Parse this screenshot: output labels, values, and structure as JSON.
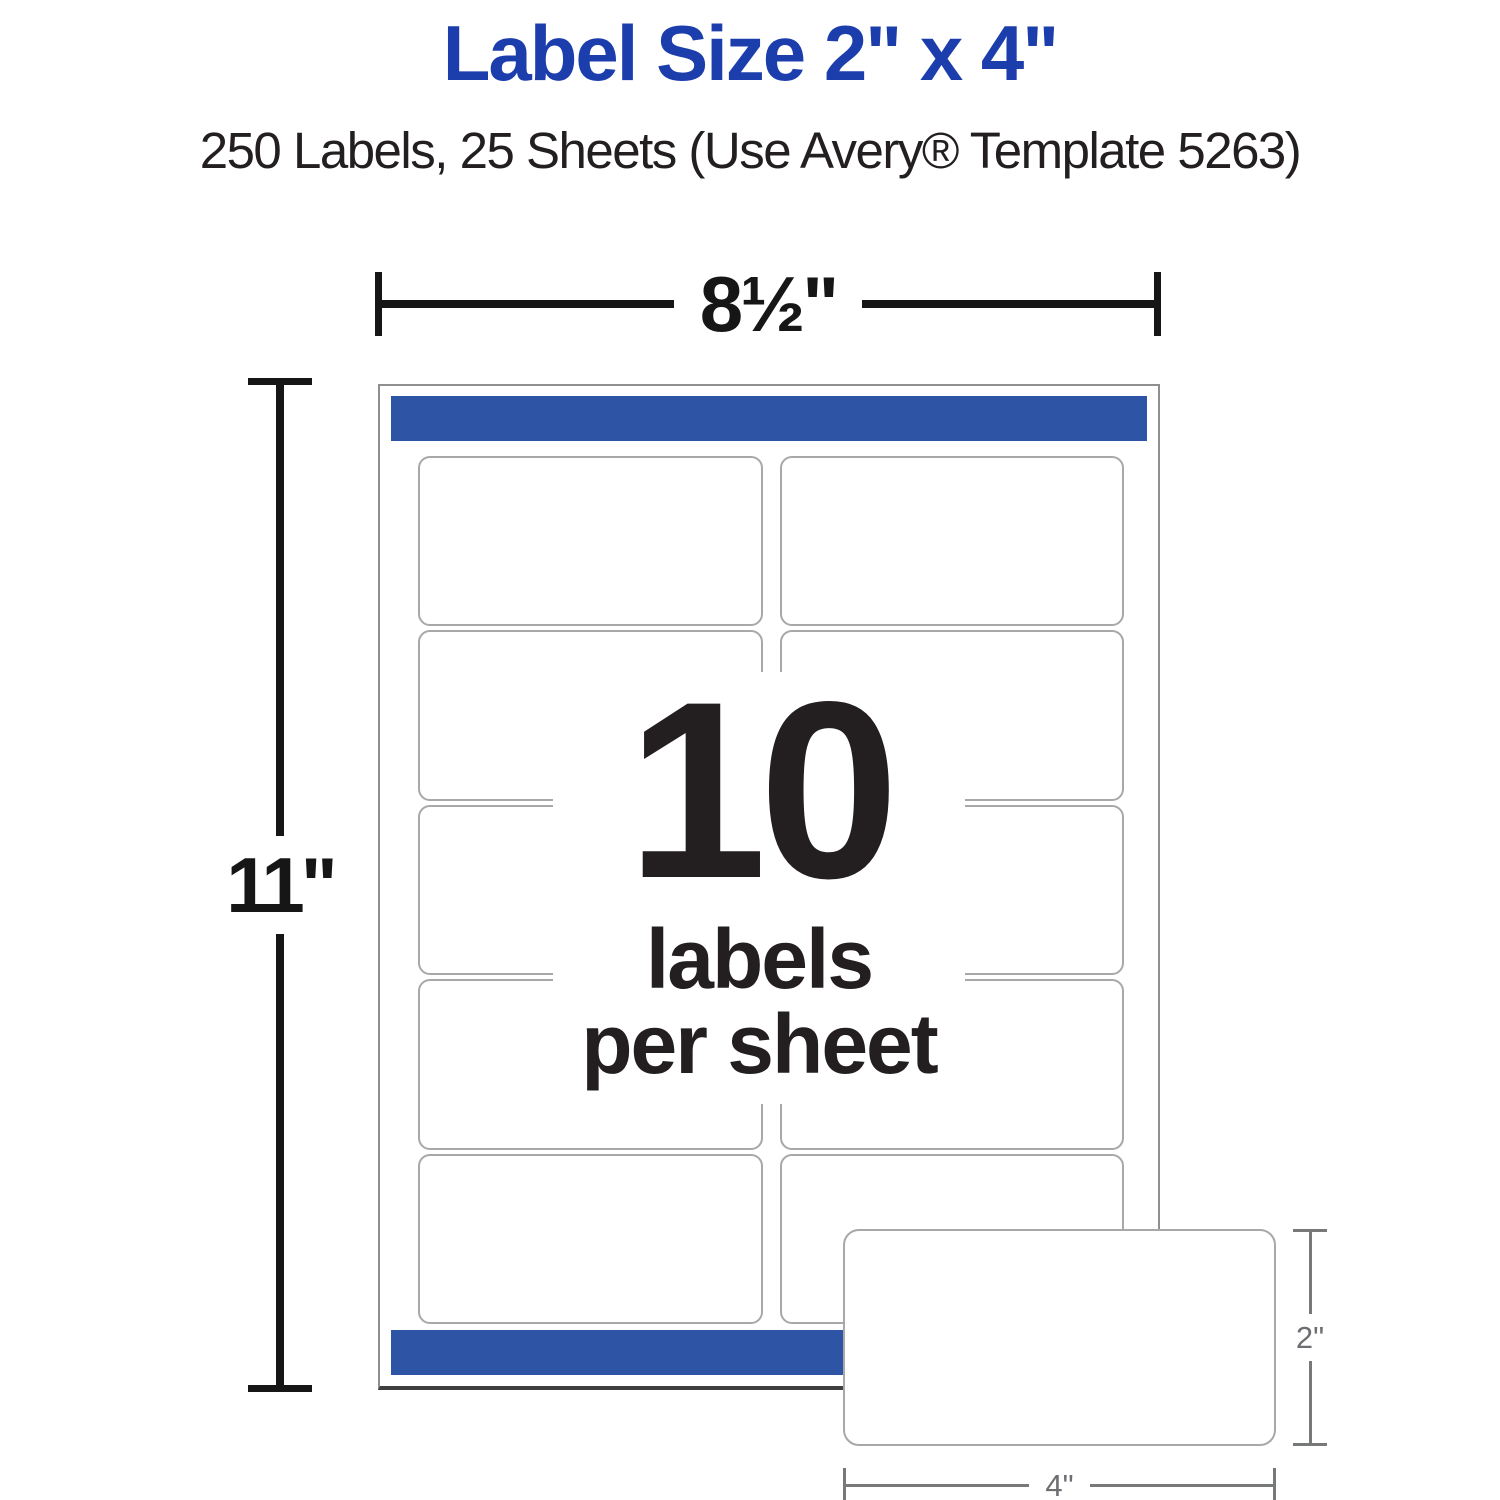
{
  "header": {
    "title": "Label Size 2\" x 4\"",
    "subtitle": "250 Labels, 25 Sheets (Use Avery® Template 5263)"
  },
  "sheet_diagram": {
    "width_dimension_label": "8½\"",
    "height_dimension_label": "11\"",
    "grid": {
      "rows": 5,
      "columns": 2
    },
    "center_caption": {
      "count": "10",
      "line1": "labels",
      "line2": "per sheet"
    }
  },
  "single_label_diagram": {
    "height_dimension_label": "2\"",
    "width_dimension_label": "4\""
  },
  "colors": {
    "bg": "#ffffff",
    "title_blue": "#1c3ead",
    "bar_blue": "#2e55a5",
    "text_dark": "#231f20",
    "dim_black": "#161616",
    "dim_gray": "#77787a",
    "dim_gray_text": "#6d6e71",
    "sheet_border": "#8f8f8f",
    "sheet_shadow": "#3f3f3f",
    "cell_border": "#a8a8a8"
  }
}
